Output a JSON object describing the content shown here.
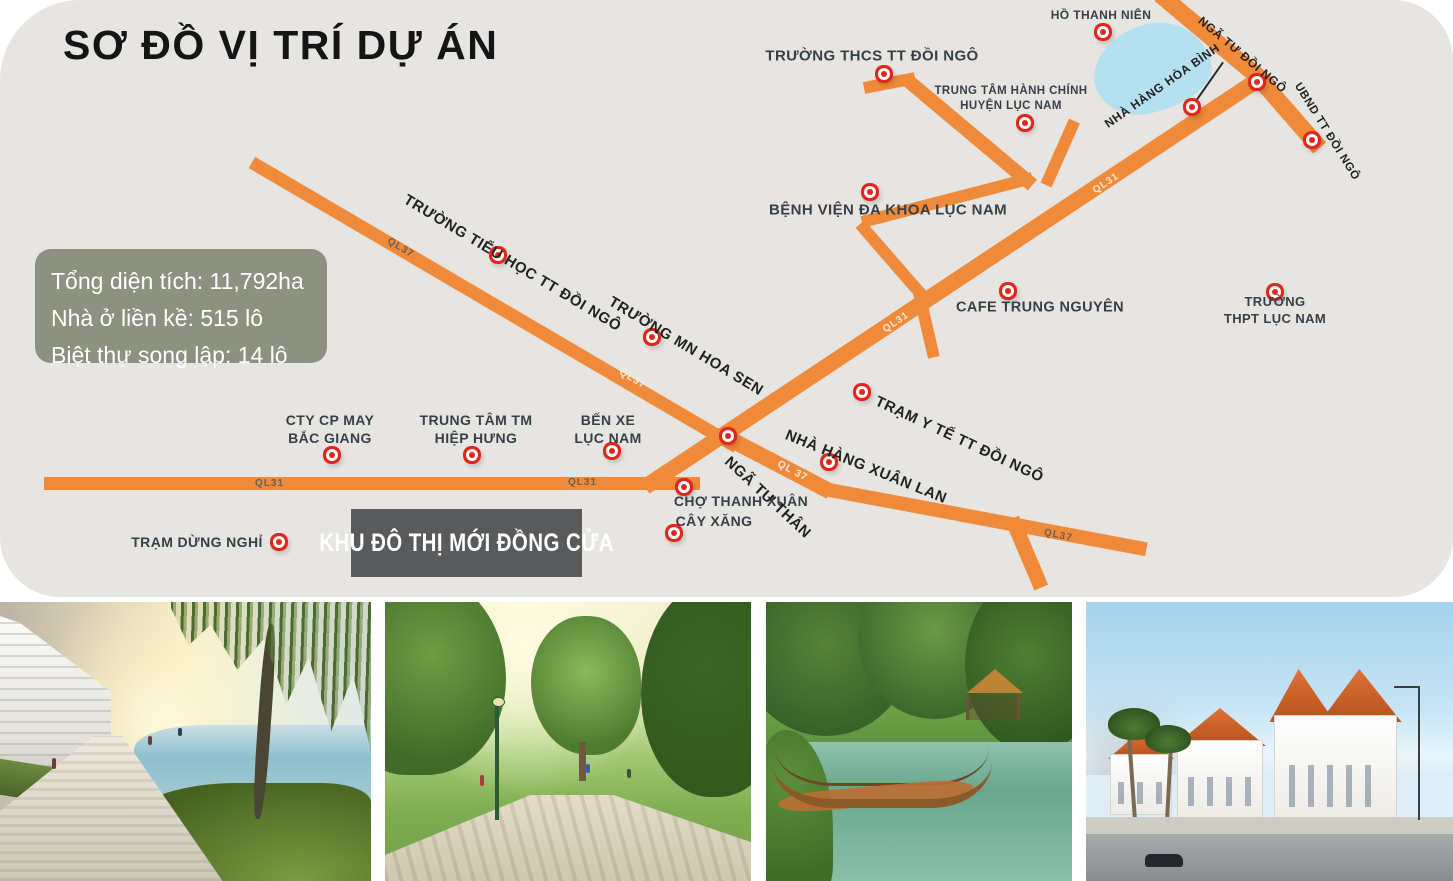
{
  "title": "SƠ ĐỒ VỊ TRÍ DỰ ÁN",
  "info_box": {
    "lines": [
      "Tổng diện tích: 11,792ha",
      "Nhà ở liền kề: 515 lô",
      "Biệt thự song lập: 14 lô"
    ]
  },
  "project_box": {
    "label": "KHU ĐÔ THỊ MỚI ĐỒNG CỬA"
  },
  "colors": {
    "road": "#ef8a3a",
    "panel": "#e7e5e2",
    "marker_red": "#e2261c",
    "info_bg": "#8c9180",
    "project_bg": "#595a5c",
    "lake": "#b5e0f0"
  },
  "road_labels": [
    {
      "text": "QL37"
    },
    {
      "text": "QL37"
    },
    {
      "text": "QL31"
    },
    {
      "text": "QL31"
    },
    {
      "text": "QL 37"
    },
    {
      "text": "QL37"
    },
    {
      "text": "QL31"
    },
    {
      "text": "QL31"
    }
  ],
  "locations": [
    {
      "id": "truong-thcs-tt-doi-ngo",
      "label": "TRƯỜNG THCS TT ĐỒI NGÔ"
    },
    {
      "id": "ho-thanh-nien",
      "label": "HỒ THANH NIÊN"
    },
    {
      "id": "trung-tam-hanh-chinh",
      "label": "TRUNG TÂM HÀNH CHÍNH\nHUYỆN LỤC NAM"
    },
    {
      "id": "nha-hang-hoa-binh",
      "label": "NHÀ HÀNG HÒA BÌNH"
    },
    {
      "id": "nga-tu-doi-ngo",
      "label": "NGÃ TƯ ĐỒI NGÔ"
    },
    {
      "id": "ubnd-tt-doi-ngo",
      "label": "UBND TT ĐỒI NGÔ"
    },
    {
      "id": "benh-vien-da-khoa-luc-nam",
      "label": "BỆNH VIỆN ĐA KHOA LỤC NAM"
    },
    {
      "id": "cafe-trung-nguyen",
      "label": "CAFE TRUNG NGUYÊN"
    },
    {
      "id": "truong-thpt-luc-nam",
      "label": "TRƯỜNG\nTHPT LỤC NAM"
    },
    {
      "id": "truong-tieu-hoc-tt-doi-ngo",
      "label": "TRƯỜNG TIỂU HỌC TT ĐỒI NGÔ"
    },
    {
      "id": "truong-mn-hoa-sen",
      "label": "TRƯỜNG MN HOA SEN"
    },
    {
      "id": "tram-y-te-tt-doi-ngo",
      "label": "TRẠM Y TẾ TT ĐỒI NGÔ"
    },
    {
      "id": "nga-tu-than",
      "label": "NGÃ TƯ THÂN"
    },
    {
      "id": "nha-hang-xuan-lan",
      "label": "NHÀ HÀNG XUÂN LAN"
    },
    {
      "id": "cho-thanh-xuan",
      "label": "CHỢ THANH XUÂN"
    },
    {
      "id": "cay-xang",
      "label": "CÂY XĂNG"
    },
    {
      "id": "ben-xe-luc-nam",
      "label": "BẾN XE\nLỤC NAM"
    },
    {
      "id": "trung-tam-tm-hiep-hung",
      "label": "TRUNG TÂM TM\nHIỆP HƯNG"
    },
    {
      "id": "cty-cp-may-bac-giang",
      "label": "CTY CP MAY\nBẮC GIANG"
    },
    {
      "id": "tram-dung-nghi",
      "label": "TRẠM DỪNG NGHỈ"
    }
  ],
  "photos": [
    {
      "name": "lakeside-promenade"
    },
    {
      "name": "central-park"
    },
    {
      "name": "canal-bridge-gazebo"
    },
    {
      "name": "villa-street"
    }
  ]
}
